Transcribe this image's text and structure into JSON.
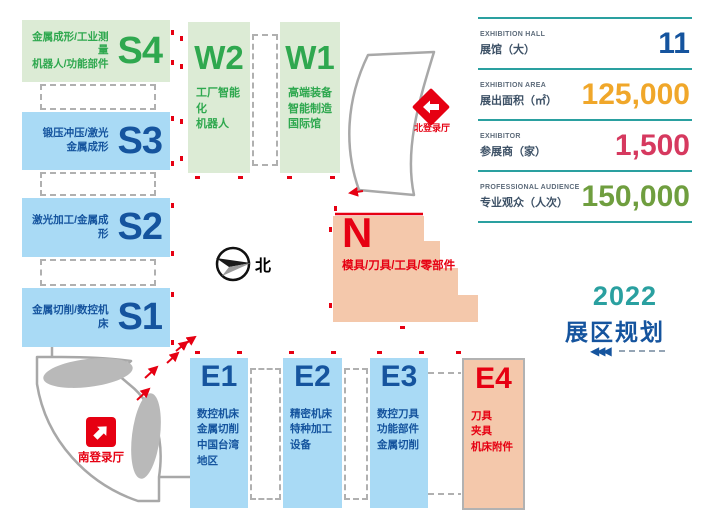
{
  "title_block": {
    "year": "2022",
    "title": "展区规划"
  },
  "compass_label": "北",
  "entrances": {
    "north": "北登录厅",
    "south": "南登录厅"
  },
  "halls": {
    "S4": {
      "code": "S4",
      "desc": "金属成形/工业测量\n机器人/功能部件"
    },
    "S3": {
      "code": "S3",
      "desc": "锻压冲压/激光\n金属成形"
    },
    "S2": {
      "code": "S2",
      "desc": "激光加工/金属成形"
    },
    "S1": {
      "code": "S1",
      "desc": "金属切削/数控机床"
    },
    "W2": {
      "code": "W2",
      "desc": "工厂智能化\n机器人"
    },
    "W1": {
      "code": "W1",
      "desc": "高端装备\n智能制造\n国际馆"
    },
    "N": {
      "code": "N",
      "desc": "模具/刀具/工具/零部件"
    },
    "E1": {
      "code": "E1",
      "desc": "数控机床\n金属切削\n中国台湾地区"
    },
    "E2": {
      "code": "E2",
      "desc": "精密机床\n特种加工设备"
    },
    "E3": {
      "code": "E3",
      "desc": "数控刀具\n功能部件\n金属切削"
    },
    "E4": {
      "code": "E4",
      "desc": "刀具\n夹具\n机床附件"
    }
  },
  "stats": [
    {
      "label_en": "EXHIBITION HALL",
      "label_zh": "展馆（大）",
      "value": "11"
    },
    {
      "label_en": "EXHIBITION AREA",
      "label_zh": "展出面积（㎡）",
      "value": "125,000"
    },
    {
      "label_en": "EXHIBITOR",
      "label_zh": "参展商（家）",
      "value": "1,500"
    },
    {
      "label_en": "PROFESSIONAL AUDIENCE",
      "label_zh": "专业观众（人次）",
      "value": "150,000"
    }
  ],
  "colors": {
    "hall_green_bg": "#dcebd5",
    "hall_green_text": "#2fa84f",
    "hall_blue_bg": "#a9daf5",
    "hall_blue_text": "#15549e",
    "hall_pink_bg": "#f4c8ab",
    "hall_red_text": "#e60012",
    "entrance_red": "#e60012",
    "accent_teal": "#2aa0a0",
    "stat_value_hall": "#15549e",
    "stat_value_area": "#f0a72a",
    "stat_value_exhibitor": "#d6395f",
    "stat_value_audience": "#6f9e3f",
    "outline_gray": "#a8a8a8"
  }
}
